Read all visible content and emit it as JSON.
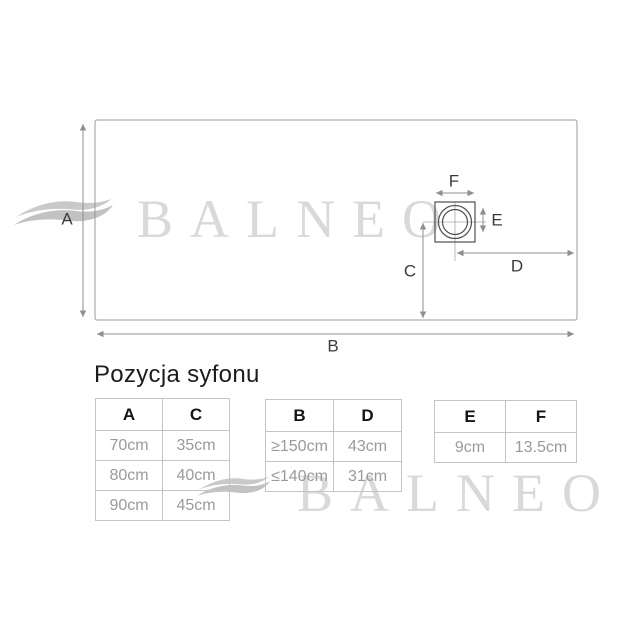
{
  "brand_watermark": {
    "text": "BALNEO"
  },
  "heading": {
    "text": "Pozycja syfonu"
  },
  "diagram": {
    "dim_labels": {
      "A": "A",
      "B": "B",
      "C": "C",
      "D": "D",
      "E": "E",
      "F": "F"
    }
  },
  "tables": [
    {
      "headers": [
        "A",
        "C"
      ],
      "rows": [
        [
          "70cm",
          "35cm"
        ],
        [
          "80cm",
          "40cm"
        ],
        [
          "90cm",
          "45cm"
        ]
      ]
    },
    {
      "headers": [
        "B",
        "D"
      ],
      "rows": [
        [
          "≥150cm",
          "43cm"
        ],
        [
          "≤140cm",
          "31cm"
        ]
      ]
    },
    {
      "headers": [
        "E",
        "F"
      ],
      "rows": [
        [
          "9cm",
          "13.5cm"
        ]
      ]
    }
  ],
  "colors": {
    "line": "#8f8f8f",
    "drawing": "#4f4f4f",
    "label": "#3c3c3c",
    "table_border": "#c4c4c4",
    "cell_text": "#9a9a9a",
    "header_text": "#151515",
    "watermark": "#d9d9d9",
    "wave": "#c9c9c9"
  }
}
